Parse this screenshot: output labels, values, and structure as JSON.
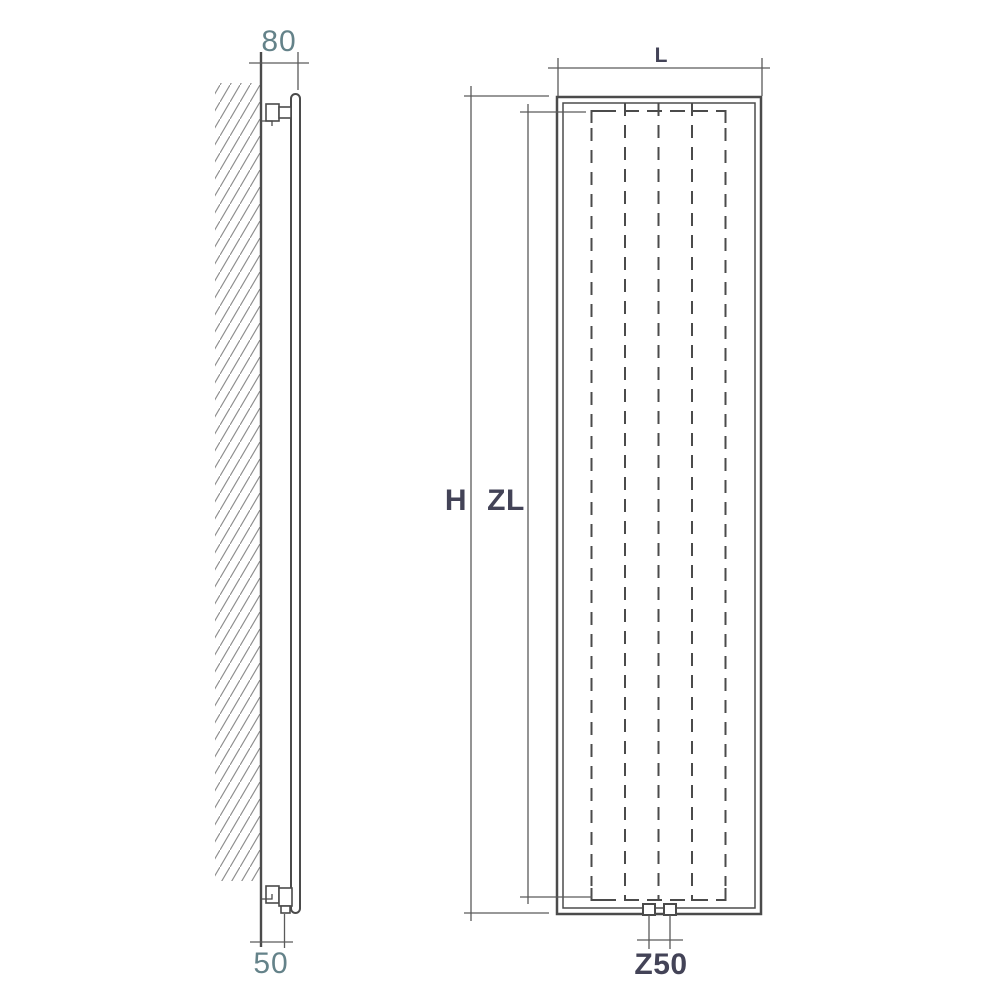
{
  "colors": {
    "line": "#4b4b4b",
    "dim_line": "#5a5a5a",
    "hatch": "#8e8e8e",
    "label_dark": "#434357",
    "label_teal": "#648289",
    "background": "#ffffff"
  },
  "side_view": {
    "depth_dimension": "80",
    "pipe_offset_dimension": "50"
  },
  "front_view": {
    "width_dimension": "L",
    "height_dimension": "H",
    "element_height_dimension": "ZL",
    "connection_spacing_dimension": "Z50"
  }
}
